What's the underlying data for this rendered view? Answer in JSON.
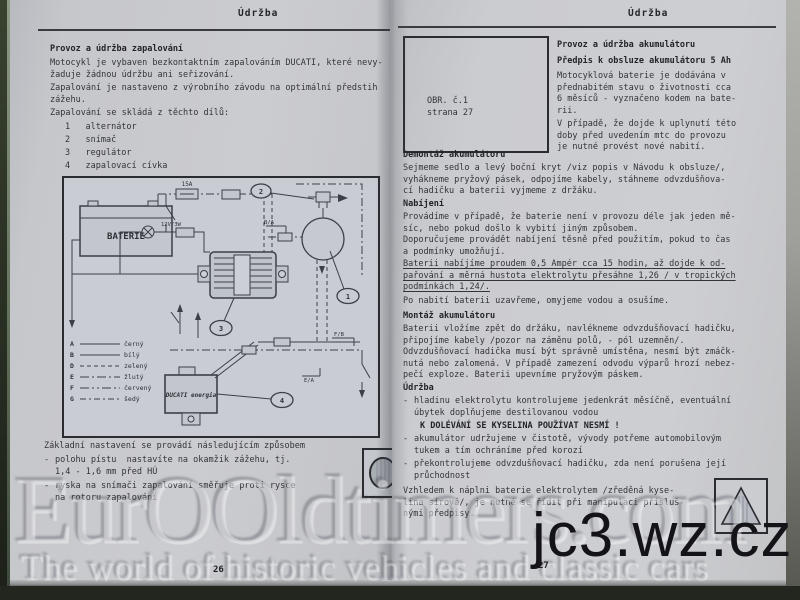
{
  "left_page": {
    "header": "Údržba",
    "title": "Provoz a údržba zapalování",
    "p1": "Motocykl je vybaven bezkontaktním zapalováním DUCATI, které nevy-\nžaduje žádnou údržbu ani seřizování.",
    "p2": "Zapalování je nastaveno z výrobního závodu na optimální předstih\nzážehu.",
    "p3": "Zapalování se skládá z těchto dílů:",
    "parts": [
      {
        "num": "1",
        "name": "alternátor"
      },
      {
        "num": "2",
        "name": "snímač"
      },
      {
        "num": "3",
        "name": "regulátor"
      },
      {
        "num": "4",
        "name": "zapalovací cívka"
      }
    ],
    "setup_title": "Základní nastavení se provádí následujícím způsobem",
    "setup_items": [
      "polohu pístu  nastavíte na okamžik zážehu, tj.\n1,4 - 1,6 mm před HÚ",
      "ryska na snímači zapalování směřuje proti rysce\nna rotoru zapalování"
    ],
    "page_number": "26",
    "diagram": {
      "battery_label": "BATERIE",
      "fuse_label": "15A",
      "bulb_label": "12V/3W",
      "unit_label": "DUCATI energia",
      "wire_labels": {
        "pickup": "B/A",
        "right": "F/B",
        "switch": "E/A"
      },
      "callout_1": "1",
      "callout_2": "2",
      "callout_3": "3",
      "callout_4": "4",
      "legend": [
        {
          "code": "A",
          "name": "černý",
          "dash": "none"
        },
        {
          "code": "B",
          "name": "bílý",
          "dash": "none"
        },
        {
          "code": "D",
          "name": "zelený",
          "dash": "4 3"
        },
        {
          "code": "E",
          "name": "žlutý",
          "dash": "9 3 2 3"
        },
        {
          "code": "F",
          "name": "červený",
          "dash": "9 3 2 3 2 3"
        },
        {
          "code": "G",
          "name": "šedý",
          "dash": "6 3 2 3"
        }
      ]
    }
  },
  "right_page": {
    "header": "Údržba",
    "figure_box": {
      "line1": "OBR. č.1",
      "line2": "strana 27"
    },
    "intro": {
      "title1": "Provoz a údržba akumulátoru",
      "title2": "Předpis k obsluze akumulátoru 5 Ah",
      "p1": "Motocyklová baterie je dodávána v\npřednabitém stavu o životnosti cca\n6 měsíců - vyznačeno kodem na bate-\nrii.",
      "p2": "V případě, že dojde k uplynutí této\ndoby před uvedením mtc do provozu\nje nutné provést nové nabití."
    },
    "demontaz": {
      "title": "Demontáž akumulátoru",
      "p1": "Sejmeme sedlo a levý boční kryt /viz popis v Návodu k obsluze/,\nvyhákneme pryžový pásek, odpojíme kabely, stáhneme odvzdušňova-\ncí hadičku a baterii vyjmeme z držáku."
    },
    "nabijeni": {
      "title": "Nabíjení",
      "p1": "Provádíme v případě, že baterie není v provozu déle jak jeden mě-\nsíc, nebo pokud došlo k vybití jiným způsobem.\nDoporučujeme provádět nabíjení těsně před použitím, pokud to čas\na podmínky umožňují.",
      "p2": "Baterii nabíjíme proudem 0,5 Ampér cca 15 hodin, až dojde k od-\npařování a měrná hustota elektrolytu přesáhne 1,26 / v tropických\npodmínkách 1,24/.",
      "p3": "Po nabití baterii uzavřeme, omyjeme vodou a osušíme."
    },
    "montaz": {
      "title": "Montáž akumulátoru",
      "p1": "Baterii vložíme zpět do držáku, navlékneme odvzdušňovací hadičku,\npřipojíme kabely /pozor na záměnu polů, - pól uzemněn/.\nOdvzdušňovací hadička musí být správně umístěna, nesmí být zmáčk-\nnutá nebo zalomená. V případě zamezení odvodu výparů hrozí nebez-\npečí exploze. Baterii upevníme pryžovým páskem."
    },
    "udrzba": {
      "title": "Údržba",
      "items": [
        "hladinu elektrolytu kontrolujeme jedenkrát měsíčně, eventuální\núbytek doplňujeme destilovanou vodou",
        "akumulátor udržujeme v čistotě, vývody potřeme automobilovým\ntukem a tím ochráníme před korozí",
        "překontrolujeme odvzdušňovací hadičku, zda není porušena její\nprůchodnost"
      ],
      "warning": "K DOLÉVÁNÍ SE KYSELINA POUŽÍVAT NESMÍ !",
      "final": "Vzhledem k náplni baterie elektrolytem /zředěná kyse-\nlina sírová/, je nutné se řídit při manipulaci přísluš-\nnými předpisy."
    },
    "page_number": "27"
  },
  "watermark": {
    "brand": "EurOOldtimers.com",
    "tagline": "The world of historic vehicles and classic cars",
    "url": "jc3.wz.cz"
  },
  "colors": {
    "paper": "#c8c9cd",
    "ink": "#33343a",
    "background": "#2c2f27"
  }
}
